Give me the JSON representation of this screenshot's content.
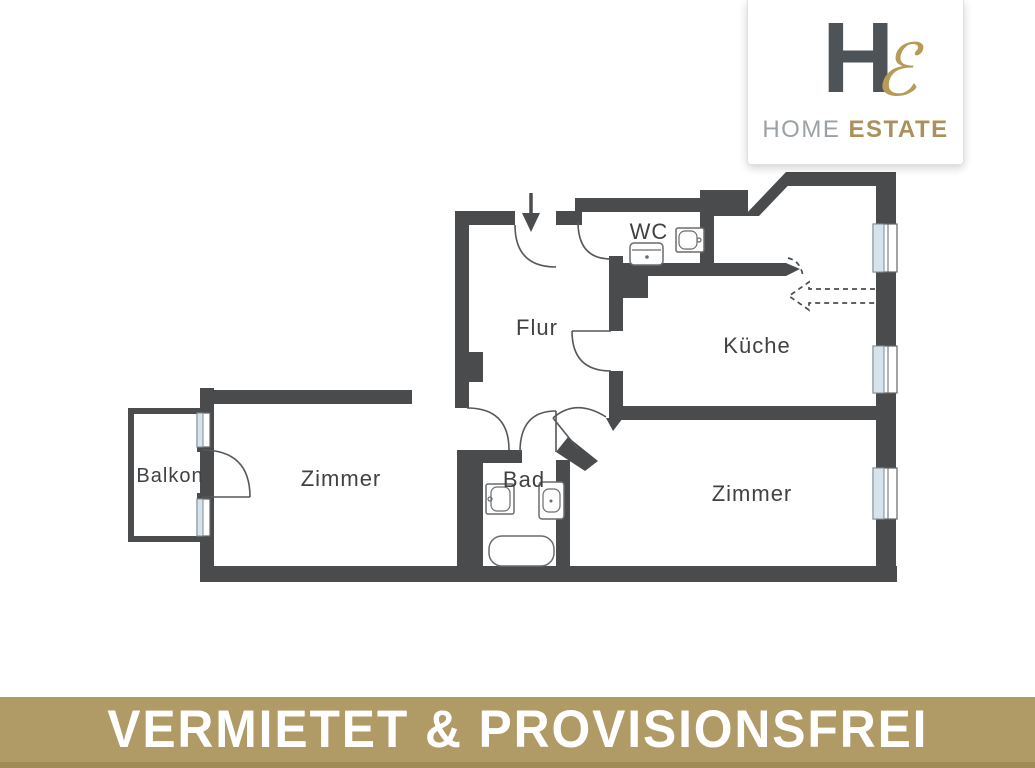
{
  "logo": {
    "monogram_h": "H",
    "monogram_e": "ℰ",
    "brand_primary": "HOME",
    "brand_secondary": "ESTATE",
    "colors": {
      "h": "#4d5357",
      "e_script": "#b79b57",
      "primary": "#9ba1a5",
      "secondary": "#aa915c"
    }
  },
  "banner": {
    "text": "VERMIETET & PROVISIONSFREI",
    "background": "#b09a66",
    "edge": "#a08b58",
    "text_color": "#ffffff"
  },
  "floorplan": {
    "colors": {
      "wall": "#494b4d",
      "door_line": "#55575a",
      "window_glass": "#d6e3ed",
      "label": "#3f4143"
    },
    "labels": [
      {
        "id": "wc",
        "label": "WC"
      },
      {
        "id": "flur",
        "label": "Flur"
      },
      {
        "id": "kueche",
        "label": "Küche"
      },
      {
        "id": "balkon",
        "label": "Balkon"
      },
      {
        "id": "zimmer-left",
        "label": "Zimmer"
      },
      {
        "id": "bad",
        "label": "Bad"
      },
      {
        "id": "zimmer-right",
        "label": "Zimmer"
      }
    ],
    "symbols": {
      "entrance_arrow_direction": "down",
      "kitchen_dashed_arrow_direction": "left",
      "windows_right_wall": 3,
      "balcony_window_strips": 2,
      "door_arcs": 7
    },
    "fixtures": {
      "wc": [
        "toilet",
        "sink"
      ],
      "bad": [
        "sink",
        "toilet",
        "bathtub"
      ]
    }
  }
}
